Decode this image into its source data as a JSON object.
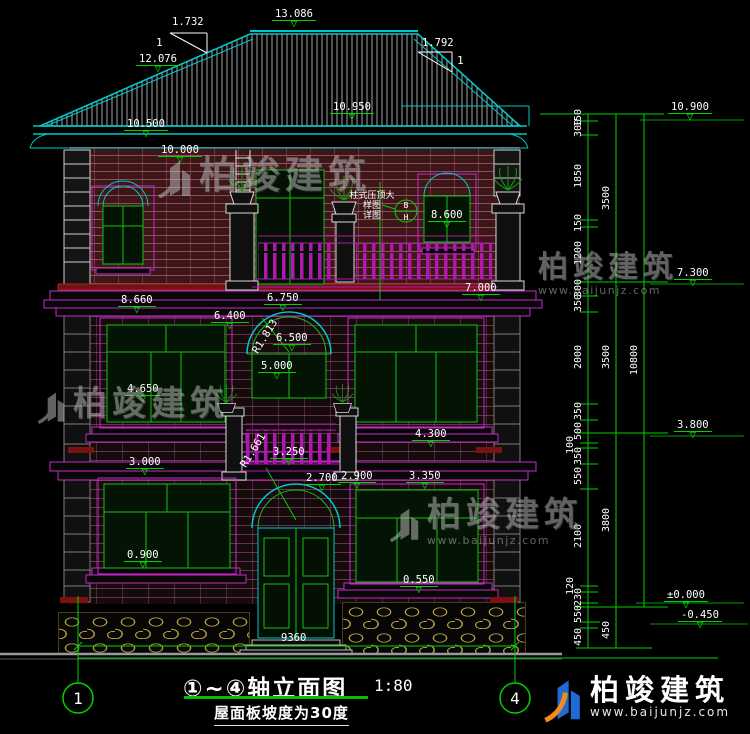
{
  "watermark": {
    "brand": "柏竣建筑",
    "url": "www.baijunjz.com"
  },
  "title": {
    "name": "①~④轴立面图",
    "scale": "1:80",
    "note": "屋面板坡度为30度"
  },
  "axes": {
    "left": "1",
    "right": "4"
  },
  "slopes": {
    "left": "1.732",
    "right": "1.792",
    "ratio": "1"
  },
  "radii": {
    "arch": "R1.813",
    "door": "R1.661"
  },
  "callout": {
    "label": "柱式压顶大样图",
    "sub": "详图",
    "top": "B",
    "bottom": "H"
  },
  "bottom_width": "9360",
  "elevations": {
    "ridge": "13.086",
    "slope_break": "12.076",
    "roof_board": "10.950",
    "eave": "10.500",
    "wall_top": "10.000",
    "balcony_rail": "8.600",
    "win3_left": "8.660",
    "win3_right": "7.000",
    "floor3": "6.750",
    "lintel3": "6.400",
    "arch_top": "6.500",
    "arch_spring": "5.000",
    "sill2_left": "4.650",
    "win2_right": "4.300",
    "sill2_right": "3.350",
    "win1_left": "3.000",
    "canopy": "3.250",
    "door_lintel": "2.900",
    "door_arch": "2.700",
    "sill1_left": "0.900",
    "sill1_right": "0.550",
    "right_eave": "10.900",
    "right_floor3": "7.300",
    "right_floor2": "3.800",
    "zero": "±0.000",
    "ground": "-0.450"
  },
  "right_dims": {
    "inner": [
      "150",
      "300",
      "1850",
      "150",
      "1200",
      "300",
      "350",
      "2000",
      "350",
      "500",
      "100",
      "350",
      "550",
      "2100",
      "120",
      "230",
      "550",
      "450"
    ],
    "middle": [
      "3500",
      "3500",
      "3800",
      "450"
    ],
    "outer": [
      "10800"
    ]
  }
}
